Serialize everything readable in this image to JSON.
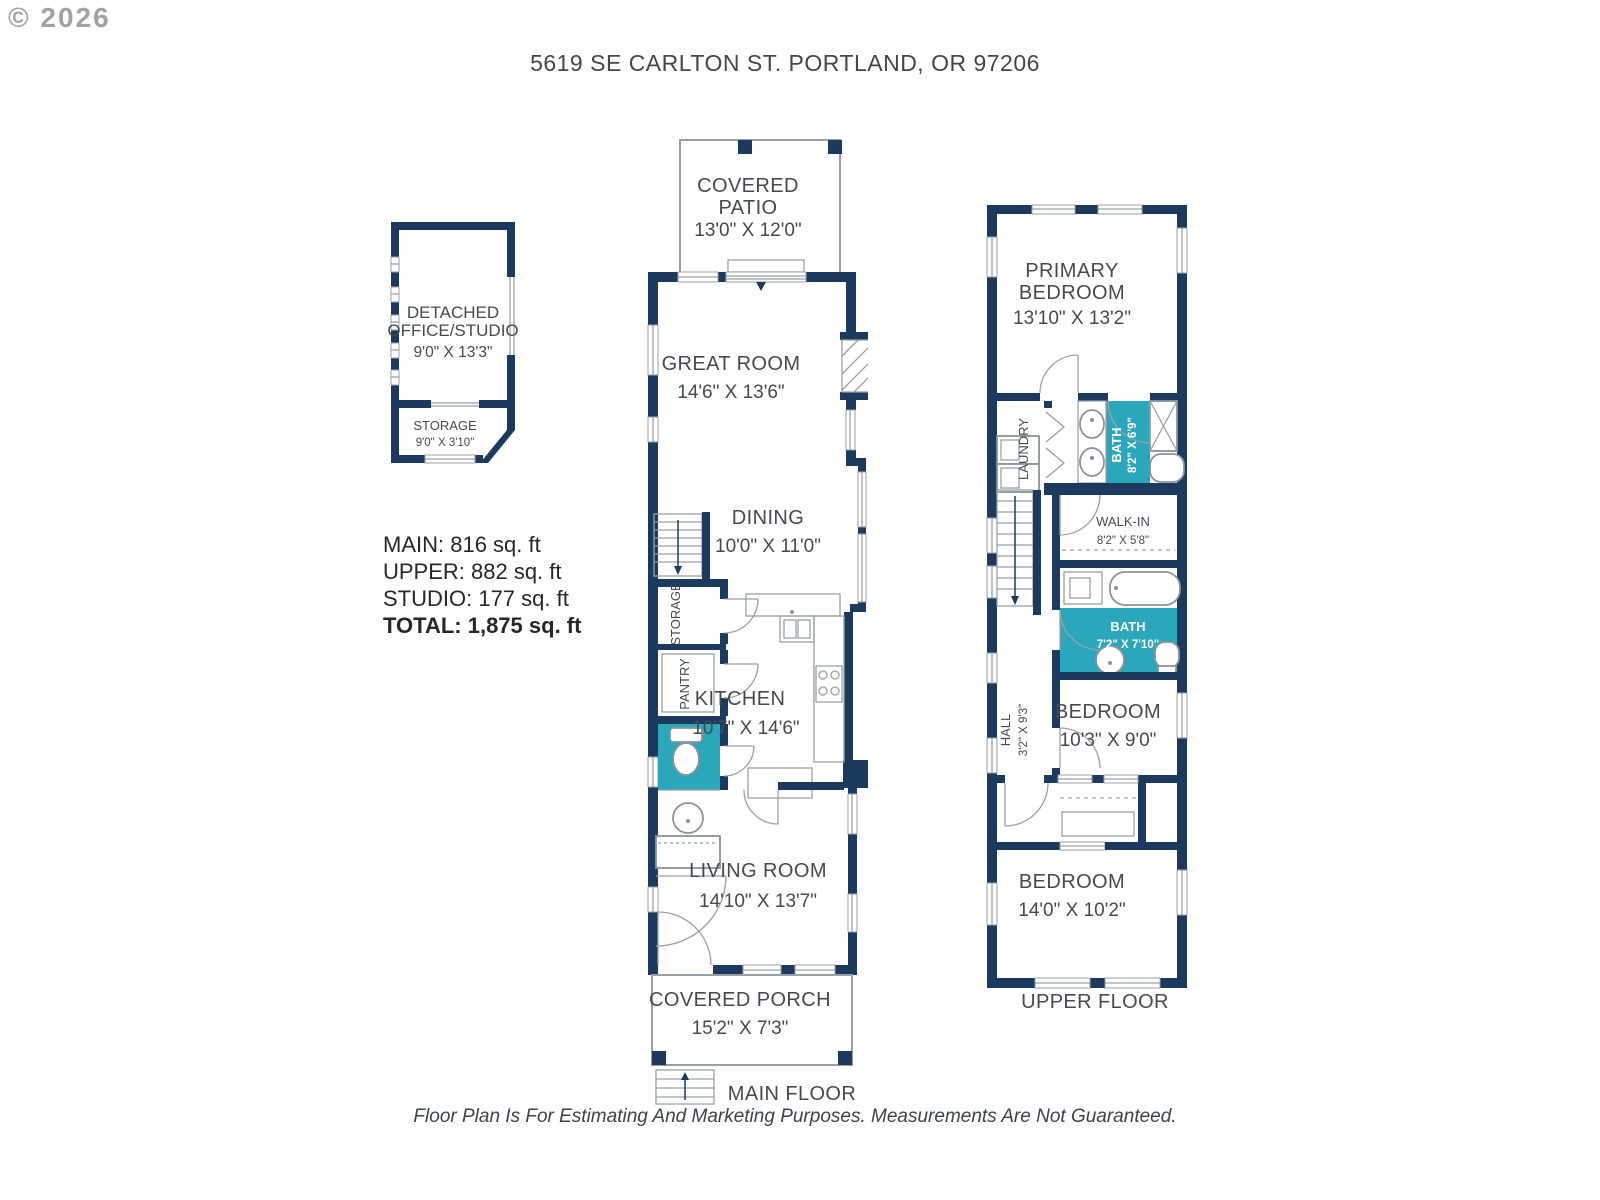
{
  "watermark": "© 2026",
  "title": "5619 SE CARLTON ST. PORTLAND, OR 97206",
  "disclaimer": "Floor Plan Is For Estimating And Marketing Purposes. Measurements Are Not Guaranteed.",
  "area_summary": {
    "main": "MAIN: 816 sq. ft",
    "upper": "UPPER: 882 sq. ft",
    "studio": "STUDIO: 177 sq. ft",
    "total": "TOTAL: 1,875 sq. ft"
  },
  "colors": {
    "wall_navy": "#1c3a5e",
    "bath_teal": "#2ba7bb",
    "line_gray": "#98a0a6",
    "label_gray": "#454a50"
  },
  "studio": {
    "name_line1": "DETACHED",
    "name_line2": "OFFICE/STUDIO",
    "dims": "9'0\" X 13'3\"",
    "storage": {
      "name": "STORAGE",
      "dims": "9'0\" X 3'10\""
    }
  },
  "main_floor": {
    "label": "MAIN FLOOR",
    "covered_patio": {
      "line1": "COVERED",
      "line2": "PATIO",
      "dims": "13'0\" X 12'0\""
    },
    "great_room": {
      "name": "GREAT ROOM",
      "dims": "14'6\" X 13'6\""
    },
    "dining": {
      "name": "DINING",
      "dims": "10'0\" X 11'0\""
    },
    "storage_label": "STORAGE",
    "pantry_label": "PANTRY",
    "kitchen": {
      "name": "KITCHEN",
      "dims": "10'7\" X 14'6\""
    },
    "living_room": {
      "name": "LIVING ROOM",
      "dims": "14'10\" X 13'7\""
    },
    "covered_porch": {
      "name": "COVERED PORCH",
      "dims": "15'2\" X 7'3\""
    }
  },
  "upper_floor": {
    "label": "UPPER FLOOR",
    "primary_bedroom": {
      "line1": "PRIMARY",
      "line2": "BEDROOM",
      "dims": "13'10\" X 13'2\""
    },
    "laundry_label": "LAUNDRY",
    "primary_bath": {
      "name": "BATH",
      "dims": "8'2\" X 6'9\""
    },
    "walk_in": {
      "name": "WALK-IN",
      "dims": "8'2\" X 5'8\""
    },
    "bath": {
      "name": "BATH",
      "dims": "7'2\" X 7'10\""
    },
    "hall": {
      "name": "HALL",
      "dims": "3'2\" X 9'3\""
    },
    "bedroom2": {
      "name": "BEDROOM",
      "dims": "10'3\" X 9'0\""
    },
    "bedroom3": {
      "name": "BEDROOM",
      "dims": "14'0\" X 10'2\""
    }
  }
}
